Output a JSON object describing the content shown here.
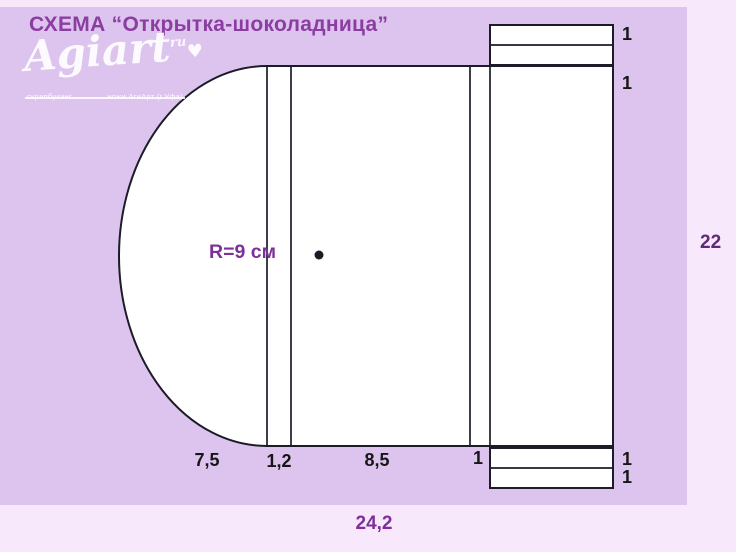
{
  "title": "СХЕМА “Открытка-шоколадница”",
  "logo": {
    "brand": "Agiart",
    "domain_suffix": "ru",
    "heart": "♥",
    "tagline_left": "скрапбукинг",
    "tagline_right": "ножи АгиАрт (г.Уфа)"
  },
  "diagram": {
    "radius_label": "R=9 см",
    "dim_semicircle_width": "7,5",
    "dim_fold_strip": "1,2",
    "dim_front_panel": "8,5",
    "dim_side_strip": "1",
    "dim_total_width": "24,2",
    "dim_height": "22",
    "dim_top_tab_outer": "1",
    "dim_top_tab_inner": "1",
    "dim_bottom_tab_outer": "1",
    "dim_bottom_tab_inner": "1"
  },
  "colors": {
    "background": "#f8e8fc",
    "panel": "#ddc4ee",
    "line": "#1c1c28",
    "ink": "#161616",
    "accent": "#8b3da1",
    "accent_deep": "#7e309a",
    "accent_dark": "#5e2a75"
  }
}
